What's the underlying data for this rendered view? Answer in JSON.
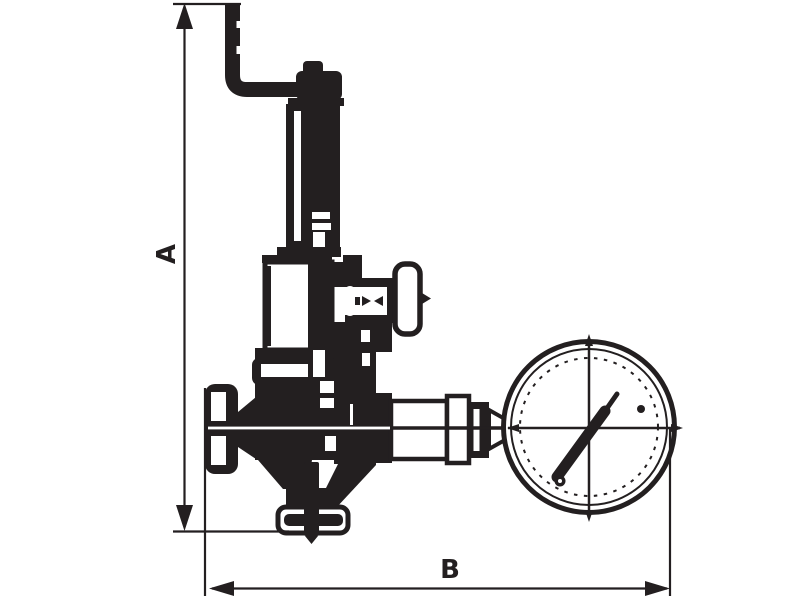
{
  "diagram": {
    "kind": "technical-line-drawing",
    "subject": "pressure reducing valve with vent pipe and pressure gauge",
    "colors": {
      "ink": "#231f20",
      "background": "#ffffff"
    },
    "dimensions": {
      "a_label": "A",
      "b_label": "B"
    },
    "components": [
      "vent-pipe",
      "spring-housing-cap",
      "spring-housing-cylinder",
      "spring-chamber",
      "adjusting-screw",
      "tee-handle",
      "valve-body",
      "hand-knob",
      "outlet-flange",
      "gauge-connection-fitting",
      "pressure-gauge",
      "gauge-needle"
    ]
  }
}
